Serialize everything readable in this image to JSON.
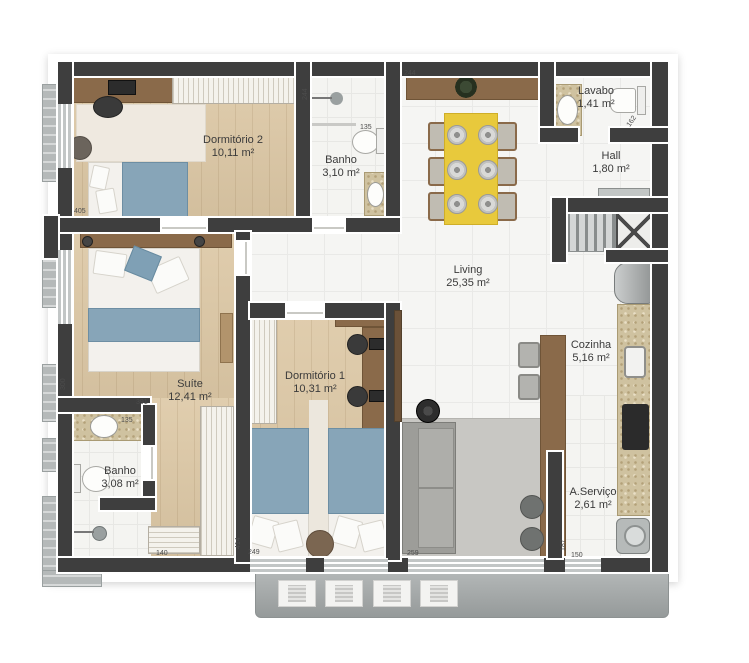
{
  "plan": {
    "title": "Apartment floor plan",
    "rooms": [
      {
        "name": "Dormitório 2",
        "area": "10,11 m²"
      },
      {
        "name": "Banho",
        "area": "3,10 m²"
      },
      {
        "name": "Lavabo",
        "area": "1,41 m²"
      },
      {
        "name": "Hall",
        "area": "1,80 m²"
      },
      {
        "name": "Living",
        "area": "25,35 m²"
      },
      {
        "name": "Suíte",
        "area": "12,41 m²"
      },
      {
        "name": "Dormitório 1",
        "area": "10,31 m²"
      },
      {
        "name": "Cozinha",
        "area": "5,16 m²"
      },
      {
        "name": "Banho",
        "area": "3,08 m²"
      },
      {
        "name": "A.Serviço",
        "area": "2,61 m²"
      }
    ],
    "dims": {
      "dorm2_width": "405",
      "banho_depth": "244",
      "banho_width": "135",
      "living_top": "244",
      "lavabo_width": "162",
      "suite_depth": "300",
      "suite_width": "391",
      "banho2_width": "135",
      "closet_width": "140",
      "dorm1_depth": "414",
      "dorm1_width": "249",
      "living_width": "259",
      "aservico_depth": "187",
      "aservico_width": "150"
    },
    "colors": {
      "wall": "#3e3e3e",
      "wood_floor": "#ddc8a5",
      "wood_furniture": "#8a6a4a",
      "tile": "#f5f5f3",
      "bed_blue": "#87a5b8",
      "table_yellow": "#e8c93c",
      "granite_counter": "#cfc2a0",
      "sofa_gray": "#9d9d99",
      "balcony_gray": "#a2a7a7"
    }
  }
}
